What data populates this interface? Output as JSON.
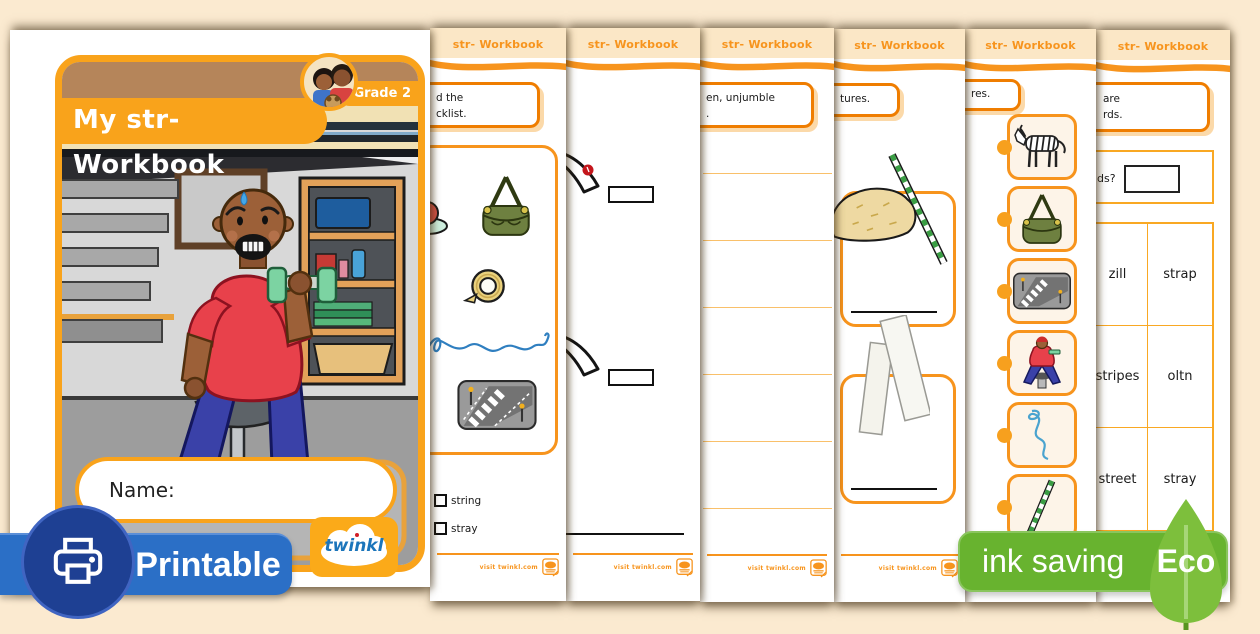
{
  "cover": {
    "title": "My str- Workbook",
    "grade_badge": "Grade 2",
    "name_label": "Name:",
    "logo_text": "twinkl",
    "illustration": "man-struggling-to-lift-dumbbell-in-garage"
  },
  "sheet_header": "str- Workbook",
  "sheet_footer": "visit twinkl.com",
  "sheets": {
    "checklist": {
      "instruction_line1": "d the",
      "instruction_line2": "cklist.",
      "checkboxes": [
        "string",
        "stray"
      ]
    },
    "unjumble": {
      "instruction_line1": "en, unjumble",
      "instruction_line2": "."
    },
    "pictures": {
      "instruction": "tures."
    },
    "cards": {
      "instruction": "res."
    },
    "word_sort": {
      "instruction_line1": "are",
      "instruction_line2": "rds.",
      "question_fragment": "ds?",
      "table": [
        [
          "zill",
          "strap"
        ],
        [
          "stripes",
          "oltn"
        ],
        [
          "street",
          "stray"
        ]
      ]
    }
  },
  "badges": {
    "printable": "Printable",
    "ink_saving": "ink saving",
    "eco": "Eco"
  },
  "colors": {
    "background": "#fbead0",
    "orange": "#f7941d",
    "orange_deep": "#ef7d00",
    "header_cream": "#fbe7c6",
    "printable_blue": "#2b6fc6",
    "printable_circle": "#1e4093",
    "eco_green": "#68b32f",
    "leaf_green": "#7dbf3c"
  },
  "icons": {
    "badge_icons": [
      "printer-icon",
      "eco-leaf-icon"
    ],
    "footer_icon": "twinkl-stamp-icon",
    "picture_icons": [
      "hat-icon",
      "strap-bag-icon",
      "sticky-tape-icon",
      "string-icon",
      "street-crossing-icon",
      "straw-pile-icon",
      "drinking-straw-icon",
      "paper-strips-icon"
    ],
    "card_icons": [
      "zebra-icon",
      "strap-bag-icon",
      "street-crossing-icon",
      "man-lifting-weights-icon",
      "string-icon",
      "drinking-straw-icon"
    ]
  }
}
